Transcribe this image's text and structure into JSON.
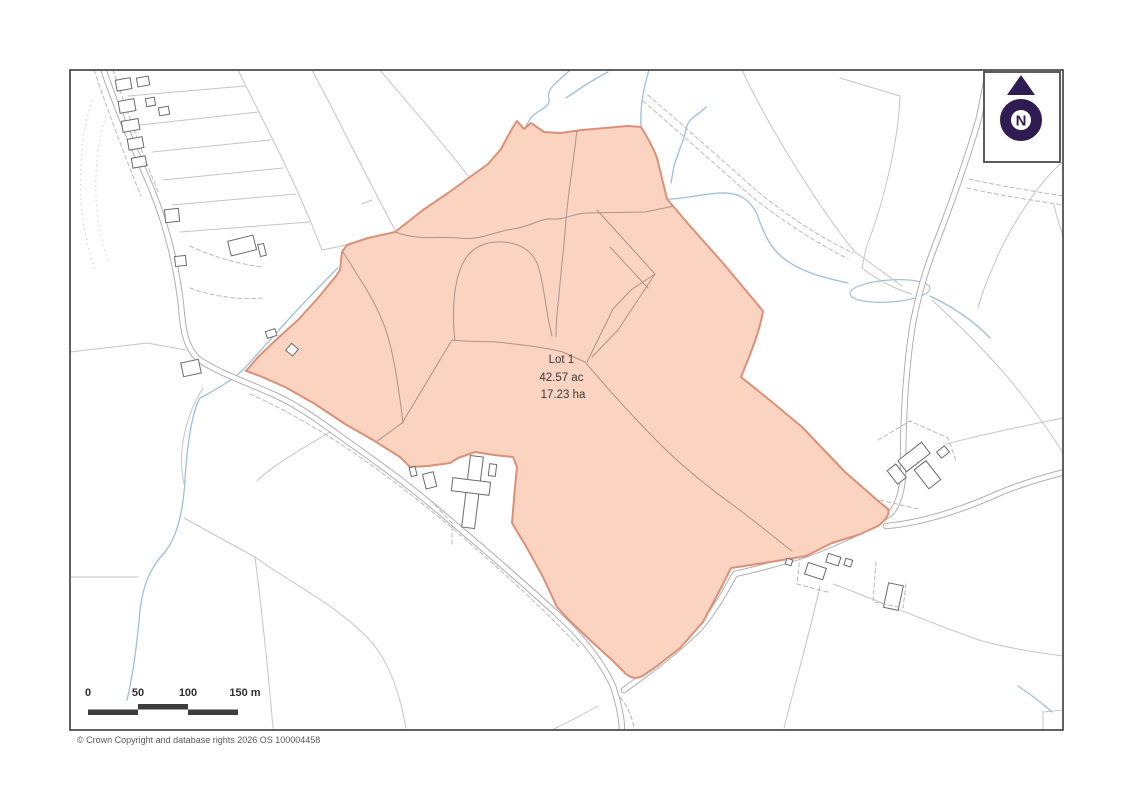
{
  "map": {
    "type": "site-plan",
    "lot": {
      "name": "Lot 1",
      "area_acres": "42.57 ac",
      "area_hectares": "17.23 ha"
    },
    "north_indicator": "N",
    "scale_bar": {
      "ticks": [
        "0",
        "50",
        "100",
        "150 m"
      ]
    },
    "attribution": "© Crown Copyright and database rights 2026 OS 100004458",
    "colors": {
      "lot_fill": "#FAD4C0",
      "lot_outline": "#DC9077",
      "internal_boundary": "#AD9289",
      "field_line": "#C5C5C5",
      "road_casing": "#ACACAC",
      "stream": "#9FBEDC",
      "building_outline": "#6B6B6B",
      "north_symbol": "#2E1C52",
      "scale_bar_fill": "#3D3D3D",
      "frame": "#3A3A3A",
      "label_text": "#3A3A3A"
    }
  }
}
